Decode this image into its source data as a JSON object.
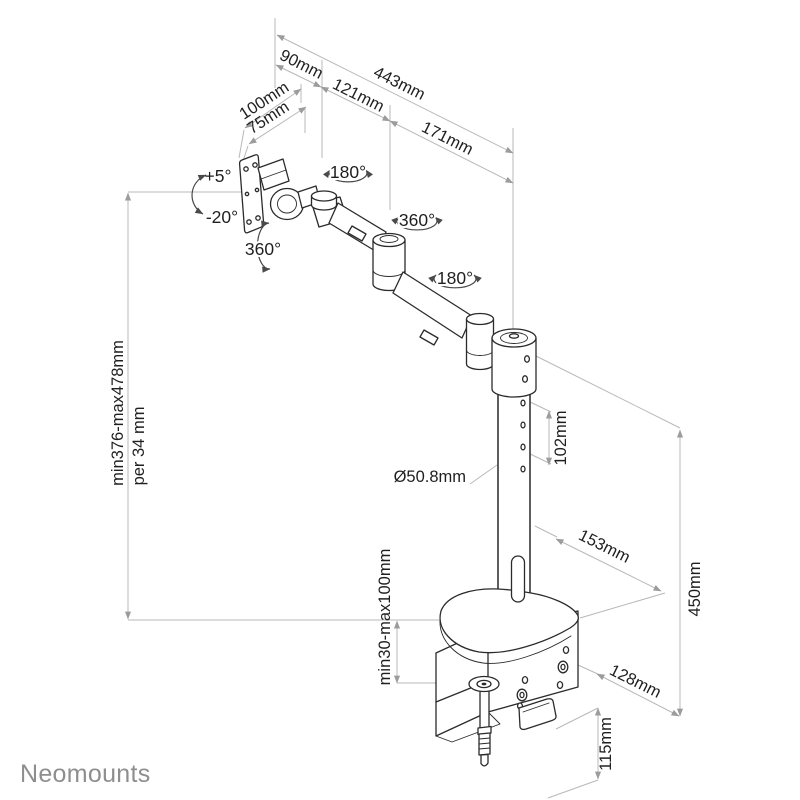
{
  "brand": {
    "name": "Neomounts"
  },
  "labels": {
    "reach_total": "443mm",
    "seg1": "90mm",
    "seg2": "121mm",
    "seg3": "171mm",
    "vesa_width": "100mm",
    "vesa_hole": "75mm",
    "tilt_up": "+5°",
    "tilt_down": "-20°",
    "swivel_vesa": "360°",
    "rotate_joint1": "180°",
    "rotate_arm": "360°",
    "rotate_joint2": "180°",
    "height_range": "min376-max478mm",
    "height_step": "per 34 mm",
    "pole_diameter": "Ø50.8mm",
    "hole_spacing": "102mm",
    "base_depth": "153mm",
    "clamp_range": "min30-max100mm",
    "pole_height": "450mm",
    "base_width": "128mm",
    "clamp_depth": "115mm"
  },
  "colors": {
    "background": "#ffffff",
    "drawing_line": "#2b2b2b",
    "dimension_line": "#b8b8b8",
    "label_text": "#1f1f1f",
    "logo_gray": "#8e8e8e"
  }
}
